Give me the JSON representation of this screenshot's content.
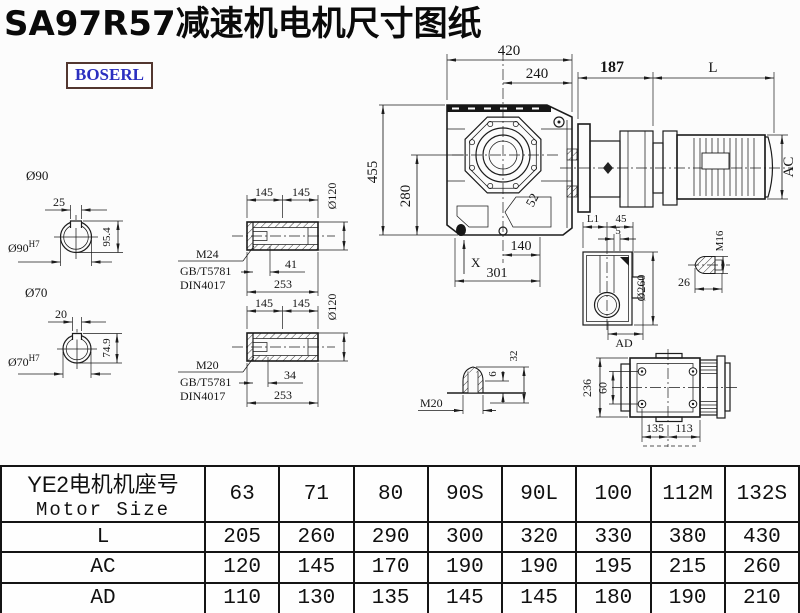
{
  "title": "SA97R57减速机电机尺寸图纸",
  "logo": {
    "text": "BOSERL"
  },
  "views": {
    "shaft90": {
      "dia_label": "Ø90",
      "key_width": "25",
      "key_height": "95.4",
      "bore": "Ø90",
      "tolerance": "H7"
    },
    "shaft70": {
      "dia_label": "Ø70",
      "key_width": "20",
      "key_height": "74.9",
      "bore": "Ø70",
      "tolerance": "H7"
    },
    "hollow_shaft_1": {
      "len_left": "145",
      "len_right": "145",
      "dia": "Ø120",
      "thread": "M24",
      "standard_gb": "GB/T5781",
      "standard_din": "DIN4017",
      "thread_depth": "41",
      "total_length": "253"
    },
    "hollow_shaft_2": {
      "len_left": "145",
      "len_right": "145",
      "dia": "Ø120",
      "thread": "M20",
      "standard_gb": "GB/T5781",
      "standard_din": "DIN4017",
      "thread_depth": "34",
      "total_length": "253"
    },
    "front_view": {
      "overall_width": "420",
      "center_to_edge": "240",
      "overall_height": "455",
      "axis_height": "280",
      "rib": "52",
      "foot_center": "140",
      "foot_width": "301",
      "datum": "X"
    },
    "motor_view": {
      "adapter_length": "187",
      "motor_length": "L",
      "motor_dia": "AC"
    },
    "side_view": {
      "dim_l1": "L1",
      "dim_45": "45",
      "dim_5": "5",
      "flange_dia": "Ø260",
      "dim_ad": "AD"
    },
    "plug_m16": {
      "thread": "M16",
      "length": "26"
    },
    "plug_m20": {
      "thread": "M20",
      "tip": "6",
      "height": "32"
    },
    "top_view": {
      "height": "236",
      "hole_spacing": "60",
      "dim_135": "135",
      "dim_113": "113"
    }
  },
  "table": {
    "header": {
      "line1": "YE2电机机座号",
      "line2": "Motor Size"
    },
    "columns": [
      "63",
      "71",
      "80",
      "90S",
      "90L",
      "100",
      "112M",
      "132S"
    ],
    "rows": [
      {
        "label": "L",
        "values": [
          "205",
          "260",
          "290",
          "300",
          "320",
          "330",
          "380",
          "430"
        ]
      },
      {
        "label": "AC",
        "values": [
          "120",
          "145",
          "170",
          "190",
          "190",
          "195",
          "215",
          "260"
        ]
      },
      {
        "label": "AD",
        "values": [
          "110",
          "130",
          "135",
          "145",
          "145",
          "180",
          "190",
          "210"
        ]
      }
    ]
  }
}
